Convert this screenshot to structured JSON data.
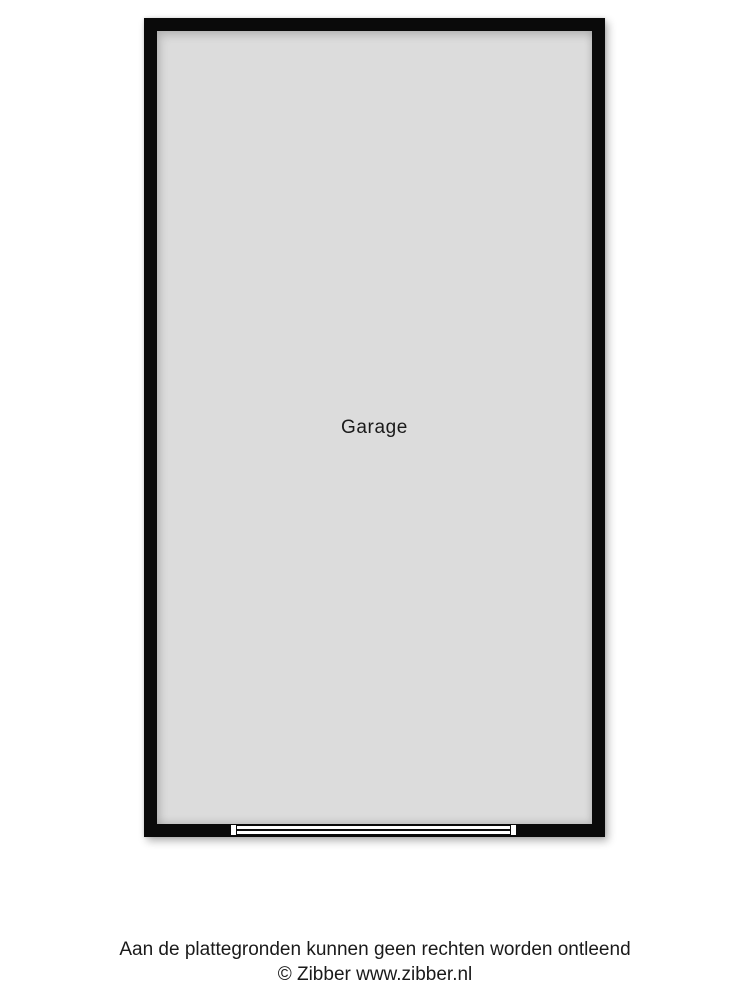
{
  "colors": {
    "background": "#ffffff",
    "wall": "#0a0a0a",
    "floor": "#dcdcdc",
    "door": "#ffffff",
    "text": "#1a1a1a"
  },
  "floorplan": {
    "room": {
      "label": "Garage"
    }
  },
  "footer": {
    "disclaimer": "Aan de plattegronden kunnen geen rechten worden ontleend",
    "copyright": "© Zibber www.zibber.nl"
  }
}
